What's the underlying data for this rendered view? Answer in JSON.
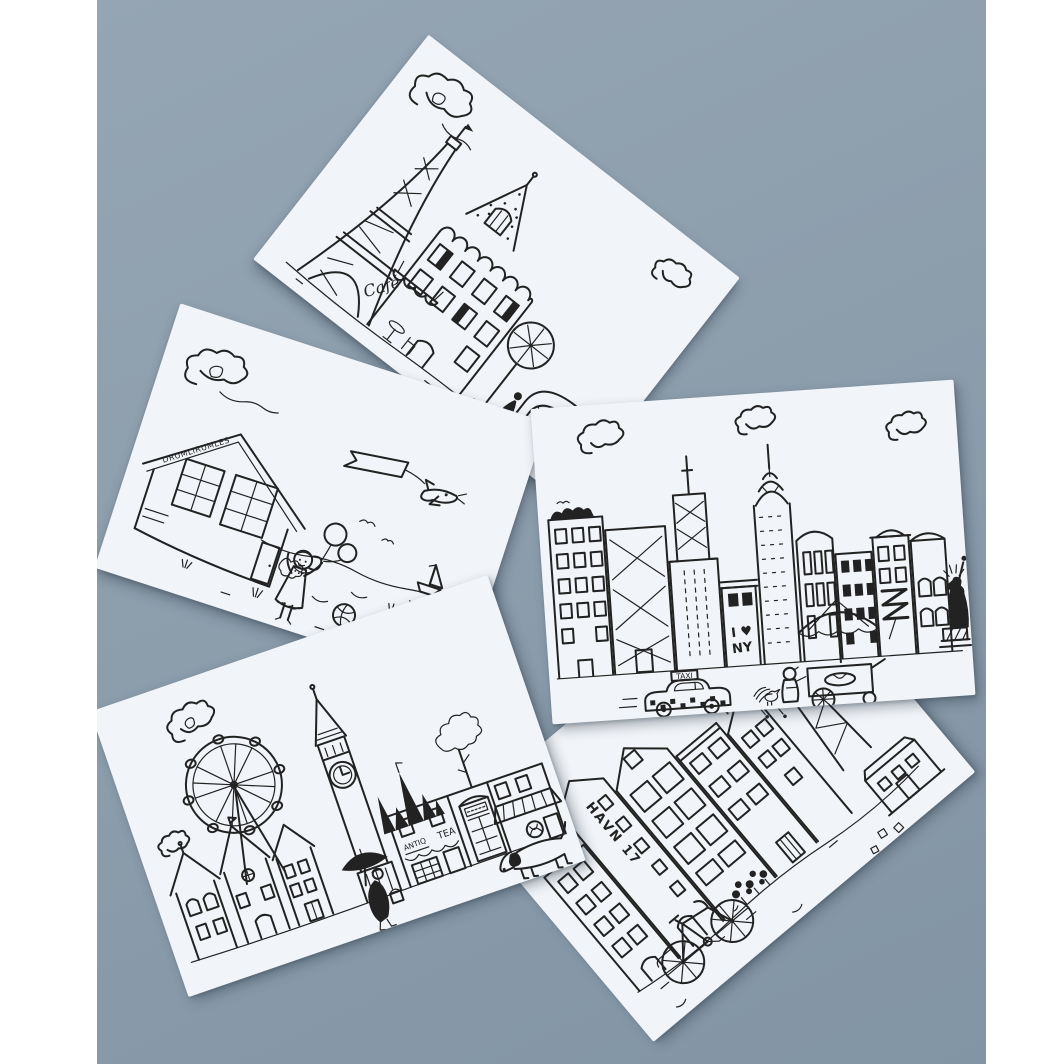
{
  "photo": {
    "background_color": "#8c9dac",
    "margin_color": "#ffffff",
    "card_color": "#f1f4f8",
    "ink_color": "#222222",
    "subject": "Five black-and-white hand-illustrated city postcards fanned out on a blue-grey backdrop"
  },
  "cards": [
    {
      "id": "paris",
      "theme": "Paris",
      "texts": {
        "cafe_sign": "Café"
      },
      "icons": [
        "cloud-icon",
        "eiffel-tower-icon",
        "montmartre-tower-icon",
        "paris-apartment-icon",
        "cafe-awning-icon",
        "bistro-table-icon",
        "tree-icon",
        "arch-icon",
        "walking-lady-icon"
      ]
    },
    {
      "id": "seaside",
      "theme": "Seaside",
      "texts": {
        "house_sign": "DRUMLIRUMLES"
      },
      "icons": [
        "cloud-icon",
        "airplane-banner-icon",
        "summer-house-icon",
        "girl-with-balloons-icon",
        "balloons-icon",
        "beach-ball-icon",
        "sailboat-icon",
        "seagull-icon",
        "dune-grass-icon"
      ]
    },
    {
      "id": "new-york",
      "theme": "New York",
      "texts": {
        "graffiti_line1": "I ♥",
        "graffiti_line2": "NY",
        "taxi_sign": "TAXI"
      },
      "icons": [
        "cloud-icon",
        "rooftop-garden-icon",
        "fire-escape-icon",
        "empire-state-building-icon",
        "chrysler-building-icon",
        "skyscraper-icon",
        "statue-of-liberty-icon",
        "taxi-icon",
        "umbrella-icon",
        "hot-dog-cart-icon",
        "street-vendor-icon",
        "pigeon-icon",
        "bananas-icon"
      ]
    },
    {
      "id": "london",
      "theme": "London",
      "texts": {
        "shop_sign_left": "ANTIQ",
        "shop_sign_right": "TEA"
      },
      "icons": [
        "cloud-icon",
        "london-eye-icon",
        "gabled-houses-icon",
        "big-ben-icon",
        "westminster-spires-icon",
        "tree-icon",
        "tea-shop-icon",
        "telephone-box-icon",
        "striped-awning-icon",
        "pretzel-icon",
        "dachshund-icon",
        "umbrella-person-icon"
      ]
    },
    {
      "id": "copenhagen",
      "theme": "Copenhagen",
      "texts": {
        "house_sign": "HAVN 17"
      },
      "icons": [
        "cloud-icon",
        "stepped-gable-house-icon",
        "nyhavn-houses-icon",
        "rooftop-cottage-icon",
        "flower-stall-icon",
        "bicycle-icon",
        "swing-carousel-icon",
        "small-house-icon",
        "bird-icon"
      ]
    }
  ]
}
